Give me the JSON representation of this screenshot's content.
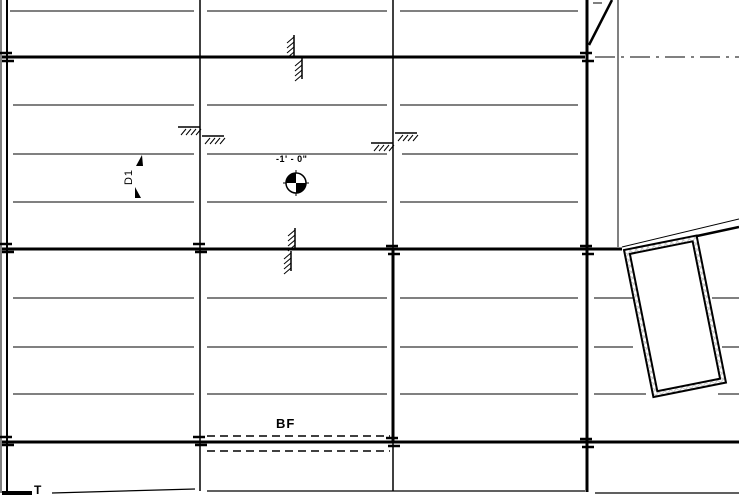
{
  "drawing": {
    "ink": "#000000",
    "bg": "#ffffff",
    "hatch_color": "#bdbdbd",
    "labels": {
      "elevation": "-1' - 0\"",
      "dimension": "D1",
      "bottom_of_footing": "BF",
      "t_mark": "T"
    },
    "canvas": {
      "width": 739,
      "height": 497
    },
    "lines": [
      {
        "x1": 10,
        "y1": 11,
        "x2": 194,
        "y2": 11,
        "w": 1,
        "name": "joist-line"
      },
      {
        "x1": 207,
        "y1": 11,
        "x2": 387,
        "y2": 11,
        "w": 1,
        "name": "joist-line"
      },
      {
        "x1": 400,
        "y1": 11,
        "x2": 578,
        "y2": 11,
        "w": 1,
        "name": "joist-line"
      },
      {
        "x1": 13,
        "y1": 105,
        "x2": 194,
        "y2": 105,
        "w": 1,
        "name": "joist-line"
      },
      {
        "x1": 207,
        "y1": 105,
        "x2": 387,
        "y2": 105,
        "w": 1,
        "name": "joist-line"
      },
      {
        "x1": 400,
        "y1": 105,
        "x2": 578,
        "y2": 105,
        "w": 1,
        "name": "joist-line"
      },
      {
        "x1": 13,
        "y1": 154,
        "x2": 194,
        "y2": 154,
        "w": 1,
        "name": "joist-line"
      },
      {
        "x1": 207,
        "y1": 154,
        "x2": 387,
        "y2": 154,
        "w": 1,
        "name": "joist-line"
      },
      {
        "x1": 402,
        "y1": 154,
        "x2": 578,
        "y2": 154,
        "w": 1,
        "name": "joist-line"
      },
      {
        "x1": 13,
        "y1": 202,
        "x2": 194,
        "y2": 202,
        "w": 1,
        "name": "joist-line"
      },
      {
        "x1": 207,
        "y1": 202,
        "x2": 387,
        "y2": 202,
        "w": 1,
        "name": "joist-line"
      },
      {
        "x1": 400,
        "y1": 202,
        "x2": 578,
        "y2": 202,
        "w": 1,
        "name": "joist-line"
      },
      {
        "x1": 13,
        "y1": 298,
        "x2": 194,
        "y2": 298,
        "w": 1,
        "name": "joist-line"
      },
      {
        "x1": 207,
        "y1": 298,
        "x2": 387,
        "y2": 298,
        "w": 1,
        "name": "joist-line"
      },
      {
        "x1": 400,
        "y1": 298,
        "x2": 578,
        "y2": 298,
        "w": 1,
        "name": "joist-line"
      },
      {
        "x1": 594,
        "y1": 298,
        "x2": 640,
        "y2": 298,
        "w": 1,
        "name": "joist-line"
      },
      {
        "x1": 712,
        "y1": 298,
        "x2": 739,
        "y2": 298,
        "w": 1,
        "name": "joist-line"
      },
      {
        "x1": 13,
        "y1": 347,
        "x2": 194,
        "y2": 347,
        "w": 1,
        "name": "joist-line"
      },
      {
        "x1": 207,
        "y1": 347,
        "x2": 387,
        "y2": 347,
        "w": 1,
        "name": "joist-line"
      },
      {
        "x1": 400,
        "y1": 347,
        "x2": 578,
        "y2": 347,
        "w": 1,
        "name": "joist-line"
      },
      {
        "x1": 594,
        "y1": 347,
        "x2": 633,
        "y2": 347,
        "w": 1,
        "name": "joist-line"
      },
      {
        "x1": 722,
        "y1": 347,
        "x2": 739,
        "y2": 347,
        "w": 1,
        "name": "joist-line"
      },
      {
        "x1": 13,
        "y1": 394,
        "x2": 194,
        "y2": 394,
        "w": 1,
        "name": "joist-line"
      },
      {
        "x1": 207,
        "y1": 394,
        "x2": 387,
        "y2": 394,
        "w": 1,
        "name": "joist-line"
      },
      {
        "x1": 400,
        "y1": 394,
        "x2": 578,
        "y2": 394,
        "w": 1,
        "name": "joist-line"
      },
      {
        "x1": 594,
        "y1": 394,
        "x2": 646,
        "y2": 394,
        "w": 1,
        "name": "joist-line"
      },
      {
        "x1": 718,
        "y1": 394,
        "x2": 739,
        "y2": 394,
        "w": 1,
        "name": "joist-line"
      },
      {
        "x1": 2,
        "y1": 57,
        "x2": 585,
        "y2": 57,
        "w": 3,
        "name": "beam-line"
      },
      {
        "x1": 2,
        "y1": 249,
        "x2": 622,
        "y2": 249,
        "w": 3,
        "name": "beam-line"
      },
      {
        "x1": 2,
        "y1": 442,
        "x2": 739,
        "y2": 442,
        "w": 3,
        "name": "beam-line"
      },
      {
        "x1": 52,
        "y1": 493,
        "x2": 195,
        "y2": 489,
        "w": 1.3,
        "name": "boundary-line"
      },
      {
        "x1": 207,
        "y1": 491,
        "x2": 585,
        "y2": 491,
        "w": 1.3,
        "name": "boundary-line"
      },
      {
        "x1": 595,
        "y1": 493,
        "x2": 739,
        "y2": 493,
        "w": 1.3,
        "name": "boundary-line"
      },
      {
        "x1": 1,
        "y1": 0,
        "x2": 1,
        "y2": 493,
        "w": 1,
        "name": "wall-edge-line"
      },
      {
        "x1": 7,
        "y1": 0,
        "x2": 7,
        "y2": 493,
        "w": 2,
        "name": "wall-edge-line"
      },
      {
        "x1": 200,
        "y1": 0,
        "x2": 200,
        "y2": 491,
        "w": 1.5,
        "name": "grid-line"
      },
      {
        "x1": 393,
        "y1": 0,
        "x2": 393,
        "y2": 250,
        "w": 1.5,
        "name": "grid-line"
      },
      {
        "x1": 393,
        "y1": 250,
        "x2": 393,
        "y2": 442,
        "w": 3,
        "name": "grid-line"
      },
      {
        "x1": 393,
        "y1": 442,
        "x2": 393,
        "y2": 491,
        "w": 1.5,
        "name": "grid-line"
      },
      {
        "x1": 587,
        "y1": 0,
        "x2": 587,
        "y2": 492,
        "w": 3,
        "name": "wall-line"
      },
      {
        "x1": 618,
        "y1": 0,
        "x2": 618,
        "y2": 247,
        "w": 1,
        "name": "wall-line"
      },
      {
        "x1": 612,
        "y1": 0,
        "x2": 589,
        "y2": 45,
        "w": 2.5,
        "name": "ramp-edge-line"
      },
      {
        "x1": 593,
        "y1": 3,
        "x2": 602,
        "y2": 3,
        "w": 1,
        "name": "ramp-tick-line"
      },
      {
        "x1": 207,
        "y1": 436,
        "x2": 390,
        "y2": 436,
        "w": 1.5,
        "dash": "8 5",
        "name": "footing-dashed-line"
      },
      {
        "x1": 207,
        "y1": 451,
        "x2": 390,
        "y2": 451,
        "w": 1.5,
        "dash": "8 5",
        "name": "footing-dashed-line"
      },
      {
        "x1": 595,
        "y1": 57,
        "x2": 739,
        "y2": 57,
        "w": 1,
        "dash": "20 6 3 6",
        "name": "centerline-dashdot"
      }
    ],
    "overlay_lines": [
      {
        "x1": 622,
        "y1": 247,
        "x2": 739,
        "y2": 219,
        "w": 1,
        "name": "eave-edge-thin-line"
      },
      {
        "x1": 697,
        "y1": 236,
        "x2": 739,
        "y2": 227,
        "w": 2.5,
        "name": "eave-edge-line"
      }
    ],
    "rects": [
      {
        "x": 2,
        "y": 491,
        "w": 30,
        "h": 4,
        "name": "wall-end-cap"
      }
    ],
    "break_ticks": [
      {
        "x": 7,
        "y": 57
      },
      {
        "x": 7,
        "y": 248
      },
      {
        "x": 7,
        "y": 441
      },
      {
        "x": 200,
        "y": 248
      },
      {
        "x": 200,
        "y": 441
      },
      {
        "x": 393,
        "y": 250
      },
      {
        "x": 393,
        "y": 442
      },
      {
        "x": 587,
        "y": 57
      },
      {
        "x": 587,
        "y": 250
      },
      {
        "x": 587,
        "y": 443
      }
    ],
    "earth_hatches": [
      {
        "x1": 178,
        "x2": 200,
        "y": 127
      },
      {
        "x1": 202,
        "x2": 224,
        "y": 136
      },
      {
        "x1": 371,
        "x2": 393,
        "y": 143
      },
      {
        "x1": 395,
        "x2": 417,
        "y": 133
      }
    ],
    "wall_hatches": [
      {
        "x": 294,
        "y1": 35,
        "y2": 56
      },
      {
        "x": 302,
        "y1": 58,
        "y2": 79
      },
      {
        "x": 295,
        "y1": 228,
        "y2": 248
      },
      {
        "x": 291,
        "y1": 251,
        "y2": 271
      }
    ],
    "datum": {
      "cx": 296,
      "cy": 183,
      "r": 10,
      "cross": 13
    },
    "dim_ticks": [
      {
        "points": "136,166 142,155 143,166"
      },
      {
        "points": "135,187 141,198 135,198"
      }
    ],
    "column": {
      "x": 624,
      "y": 250,
      "w": 74,
      "h": 150,
      "angle": -11.3,
      "inset": 5
    }
  }
}
